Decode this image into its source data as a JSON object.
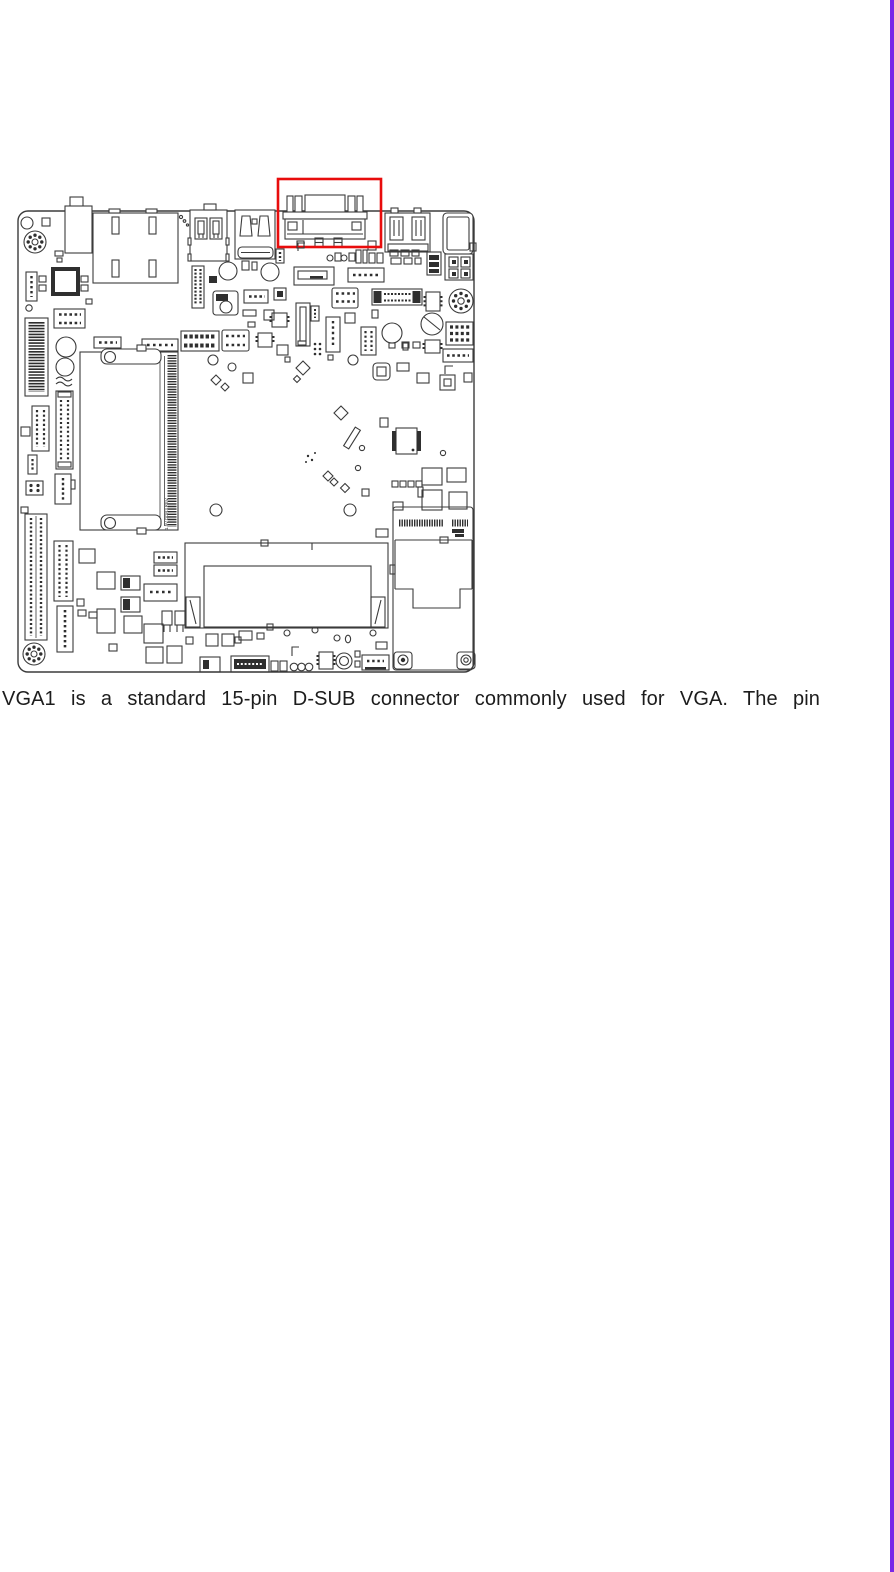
{
  "page": {
    "background": "#ffffff",
    "edge_stripe_color": "#7a26e8"
  },
  "figure": {
    "type": "motherboard-line-diagram",
    "line_color": "#3b3b3b",
    "highlight_color": "#e80c0c",
    "highlighted_component": "vga-dsub-connector",
    "board_vertical_label": "1.5V DDR3 REV",
    "components": [
      "audio-jack",
      "lan-connector",
      "usb-double-stack-left",
      "usb-hdmi-stack",
      "vga-dsub-connector",
      "usb-double-stack-right",
      "dc-power-jack",
      "sata-connector",
      "rtc-battery",
      "so-dimm-socket-1",
      "so-dimm-socket-2",
      "mini-pcie-slot-bracket",
      "pin-headers",
      "mounting-holes",
      "power-connector-2x2"
    ]
  },
  "caption": {
    "text": "VGA1 is a standard 15-pin D-SUB connector commonly used for VGA. The pin"
  }
}
